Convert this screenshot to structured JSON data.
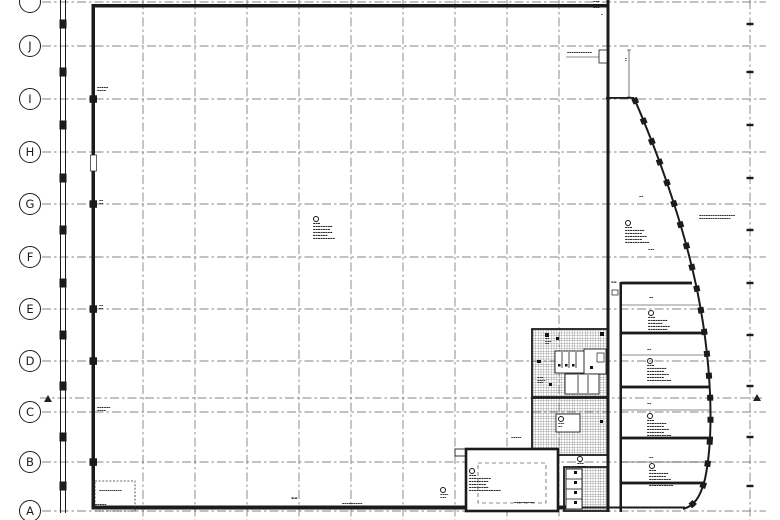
{
  "meta": {
    "title": "floor-plan-drawing",
    "paper_color": "#ffffff",
    "ink_color": "#1b1b1b",
    "grid_color": "#5f5f5f",
    "hatch_color": "#3a3a3a"
  },
  "grid": {
    "rows": [
      {
        "label": "",
        "y": 2
      },
      {
        "label": "J",
        "y": 46
      },
      {
        "label": "I",
        "y": 99
      },
      {
        "label": "H",
        "y": 152
      },
      {
        "label": "G",
        "y": 204
      },
      {
        "label": "F",
        "y": 257
      },
      {
        "label": "E",
        "y": 309
      },
      {
        "label": "D",
        "y": 361
      },
      {
        "label": "C",
        "y": 412
      },
      {
        "label": "B",
        "y": 462
      },
      {
        "label": "A",
        "y": 511
      }
    ],
    "extra_axis_y": 398,
    "col_xs": [
      143,
      195,
      247,
      299,
      351,
      403,
      455,
      507,
      559
    ],
    "dim_line_x": 750,
    "left_wall_tick_ys": [
      24,
      72,
      125,
      178,
      230,
      283,
      335,
      386,
      437,
      486
    ],
    "right_dim_tick_ys": [
      24,
      72,
      125,
      178,
      230,
      283,
      335,
      386,
      437,
      486
    ],
    "wall_column_ys": [
      99,
      204,
      309,
      361,
      462
    ]
  },
  "annotations": [
    {
      "x": 97,
      "y": 87,
      "fs": 2.4,
      "marker": false,
      "lines": [
        "▬▬▬▬▬",
        "▬▬▬▬"
      ]
    },
    {
      "x": 97,
      "y": 407,
      "fs": 2.4,
      "marker": false,
      "lines": [
        "▬▬▬▬▬▬",
        "▬▬▬▬"
      ]
    },
    {
      "x": 99,
      "y": 200,
      "fs": 2.2,
      "marker": false,
      "lines": [
        "▬▬",
        "▬▬"
      ]
    },
    {
      "x": 99,
      "y": 305,
      "fs": 2.2,
      "marker": false,
      "lines": [
        "▬▬",
        "▬▬"
      ]
    },
    {
      "x": 593,
      "y": 1,
      "fs": 2.4,
      "marker": false,
      "lines": [
        "▬▬▬",
        "▬▬▬",
        "▬▬▬"
      ]
    },
    {
      "x": 567,
      "y": 52,
      "fs": 2.4,
      "marker": false,
      "lines": [
        "▬▬▬▬▬▬▬▬▬▬▬"
      ]
    },
    {
      "x": 313,
      "y": 216,
      "fs": 2.6,
      "marker": true,
      "lines": [
        "▬▬▬",
        "▬▬▬▬▬▬▬▬",
        "▬▬▬▬▬▬▬",
        "▬▬▬▬▬▬▬▬",
        "▬▬▬▬▬▬",
        "▬▬▬▬▬▬▬▬▬"
      ]
    },
    {
      "x": 625,
      "y": 220,
      "fs": 2.6,
      "marker": true,
      "lines": [
        "▬▬▬",
        "▬▬▬▬▬▬▬▬",
        "▬▬▬▬▬▬▬",
        "▬▬▬▬▬▬▬▬▬",
        "▬▬▬▬▬▬▬",
        "▬▬▬▬▬▬▬▬▬▬"
      ]
    },
    {
      "x": 699,
      "y": 215,
      "fs": 2.4,
      "marker": false,
      "lines": [
        "▬▬▬▬▬▬▬▬▬▬▬▬▬▬▬▬",
        "▬▬▬▬▬▬▬▬▬▬▬▬▬▬"
      ]
    },
    {
      "x": 648,
      "y": 310,
      "fs": 2.6,
      "marker": true,
      "lines": [
        "▬▬▬",
        "▬▬▬▬▬▬▬▬",
        "▬▬▬▬▬▬",
        "▬▬▬▬▬▬▬▬▬",
        "▬▬▬▬▬▬▬▬",
        "▬▬▬▬▬▬▬▬▬▬"
      ]
    },
    {
      "x": 647,
      "y": 358,
      "fs": 2.6,
      "marker": true,
      "lines": [
        "▬▬▬",
        "▬▬▬▬▬▬▬▬",
        "▬▬▬▬▬▬▬",
        "▬▬▬▬▬▬▬▬▬",
        "▬▬▬▬▬▬▬",
        "▬▬▬▬▬▬▬▬▬▬"
      ]
    },
    {
      "x": 647,
      "y": 413,
      "fs": 2.6,
      "marker": true,
      "lines": [
        "▬▬▬",
        "▬▬▬▬▬▬▬▬",
        "▬▬▬▬▬▬▬",
        "▬▬▬▬▬▬▬▬▬",
        "▬▬▬▬▬▬▬",
        "▬▬▬▬▬▬▬▬▬▬"
      ]
    },
    {
      "x": 649,
      "y": 463,
      "fs": 2.6,
      "marker": true,
      "lines": [
        "▬▬▬",
        "▬▬▬▬▬▬▬▬",
        "▬▬▬▬▬▬▬",
        "▬▬▬▬▬▬▬▬▬",
        "▬▬▬▬▬▬▬",
        "▬▬▬▬▬▬▬▬▬▬"
      ]
    },
    {
      "x": 469,
      "y": 468,
      "fs": 2.6,
      "marker": true,
      "lines": [
        "▬▬▬",
        "▬▬▬▬▬▬▬▬▬",
        "▬▬▬▬▬▬▬▬",
        "▬▬▬▬▬▬▬",
        "▬▬▬▬▬▬▬▬",
        "▬▬▬▬▬▬▬▬▬▬▬▬▬"
      ]
    },
    {
      "x": 577,
      "y": 456,
      "fs": 2.4,
      "marker": true,
      "lines": [
        "▬▬▬",
        "▬▬▬▬"
      ]
    },
    {
      "x": 545,
      "y": 338,
      "fs": 2.2,
      "marker": false,
      "lines": [
        "▬▬",
        "▬▬▬",
        "▬▬"
      ]
    },
    {
      "x": 537,
      "y": 377,
      "fs": 2.2,
      "marker": false,
      "lines": [
        "▬▬▬",
        "▬▬▬▬",
        "▬▬▬"
      ]
    },
    {
      "x": 558,
      "y": 416,
      "fs": 2.2,
      "marker": true,
      "lines": [
        "▬▬▬",
        "▬▬"
      ]
    },
    {
      "x": 440,
      "y": 487,
      "fs": 2.2,
      "marker": true,
      "lines": [
        "▬▬▬▬",
        "▬▬▬"
      ]
    },
    {
      "x": 511,
      "y": 437,
      "fs": 2.2,
      "marker": false,
      "lines": [
        "▬▬▬▬▬"
      ]
    },
    {
      "x": 99,
      "y": 490,
      "fs": 2.2,
      "marker": false,
      "lines": [
        "▬▬▬▬▬▬▬▬▬▬▬"
      ]
    },
    {
      "x": 93,
      "y": 504,
      "fs": 2.4,
      "marker": false,
      "lines": [
        "▬▬▬▬▬▬"
      ]
    },
    {
      "x": 342,
      "y": 503,
      "fs": 2.4,
      "marker": false,
      "lines": [
        "▬▬▬▬▬▬▬▬▬"
      ]
    },
    {
      "x": 514,
      "y": 502,
      "fs": 2.4,
      "marker": false,
      "lines": [
        "▬▬▬▬▬▬▬▬▬"
      ]
    },
    {
      "x": 291,
      "y": 497,
      "fs": 3.4,
      "marker": false,
      "lines": [
        "▬▬"
      ]
    },
    {
      "x": 611,
      "y": 281,
      "fs": 3.0,
      "marker": false,
      "lines": [
        "▬▬"
      ]
    },
    {
      "x": 625,
      "y": 58,
      "fs": 2.0,
      "marker": false,
      "lines": [
        "▬",
        "▬"
      ]
    },
    {
      "x": 601,
      "y": 14,
      "fs": 2.0,
      "marker": false,
      "lines": [
        "▬"
      ]
    }
  ],
  "dims": [
    {
      "x": 639,
      "y": 196,
      "text": "▬▬"
    },
    {
      "x": 648,
      "y": 249,
      "text": "▬▬▬"
    },
    {
      "x": 649,
      "y": 297,
      "text": "▬▬"
    },
    {
      "x": 647,
      "y": 349,
      "text": "▬▬"
    },
    {
      "x": 647,
      "y": 403,
      "text": "▬▬"
    },
    {
      "x": 649,
      "y": 457,
      "text": "▬▬"
    }
  ]
}
